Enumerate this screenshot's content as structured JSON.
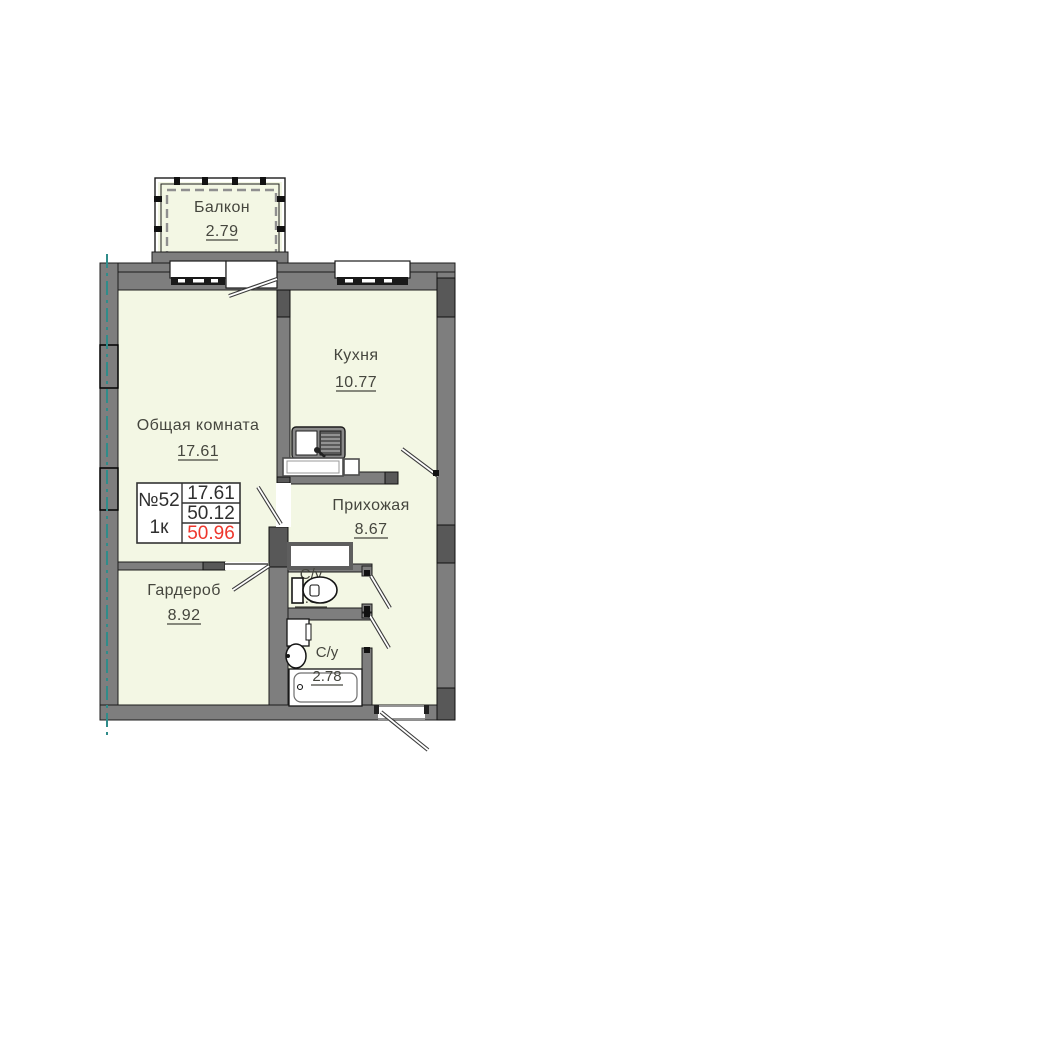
{
  "plan": {
    "title": "apartment-floor-plan",
    "rooms": [
      {
        "id": "balcony",
        "name": "Балкон",
        "area": "2.79"
      },
      {
        "id": "kitchen",
        "name": "Кухня",
        "area": "10.77"
      },
      {
        "id": "living",
        "name": "Общая комната",
        "area": "17.61"
      },
      {
        "id": "hallway",
        "name": "Прихожая",
        "area": "8.67"
      },
      {
        "id": "wardrobe",
        "name": "Гардероб",
        "area": "8.92"
      },
      {
        "id": "wc",
        "name": "С/у",
        "area": "1.37"
      },
      {
        "id": "bathroom",
        "name": "С/у",
        "area": "2.78"
      }
    ],
    "info_box": {
      "number": "№52",
      "rooms_count": "1к",
      "living_area": "17.61",
      "area_without_balcony": "50.12",
      "total_area": "50.96"
    },
    "colors": {
      "room_fill": "#f3f7e4",
      "wall": "#7e7e7e",
      "accent_red": "#ee362c",
      "axis_teal": "#2f8c8a",
      "text": "#45463e"
    }
  }
}
